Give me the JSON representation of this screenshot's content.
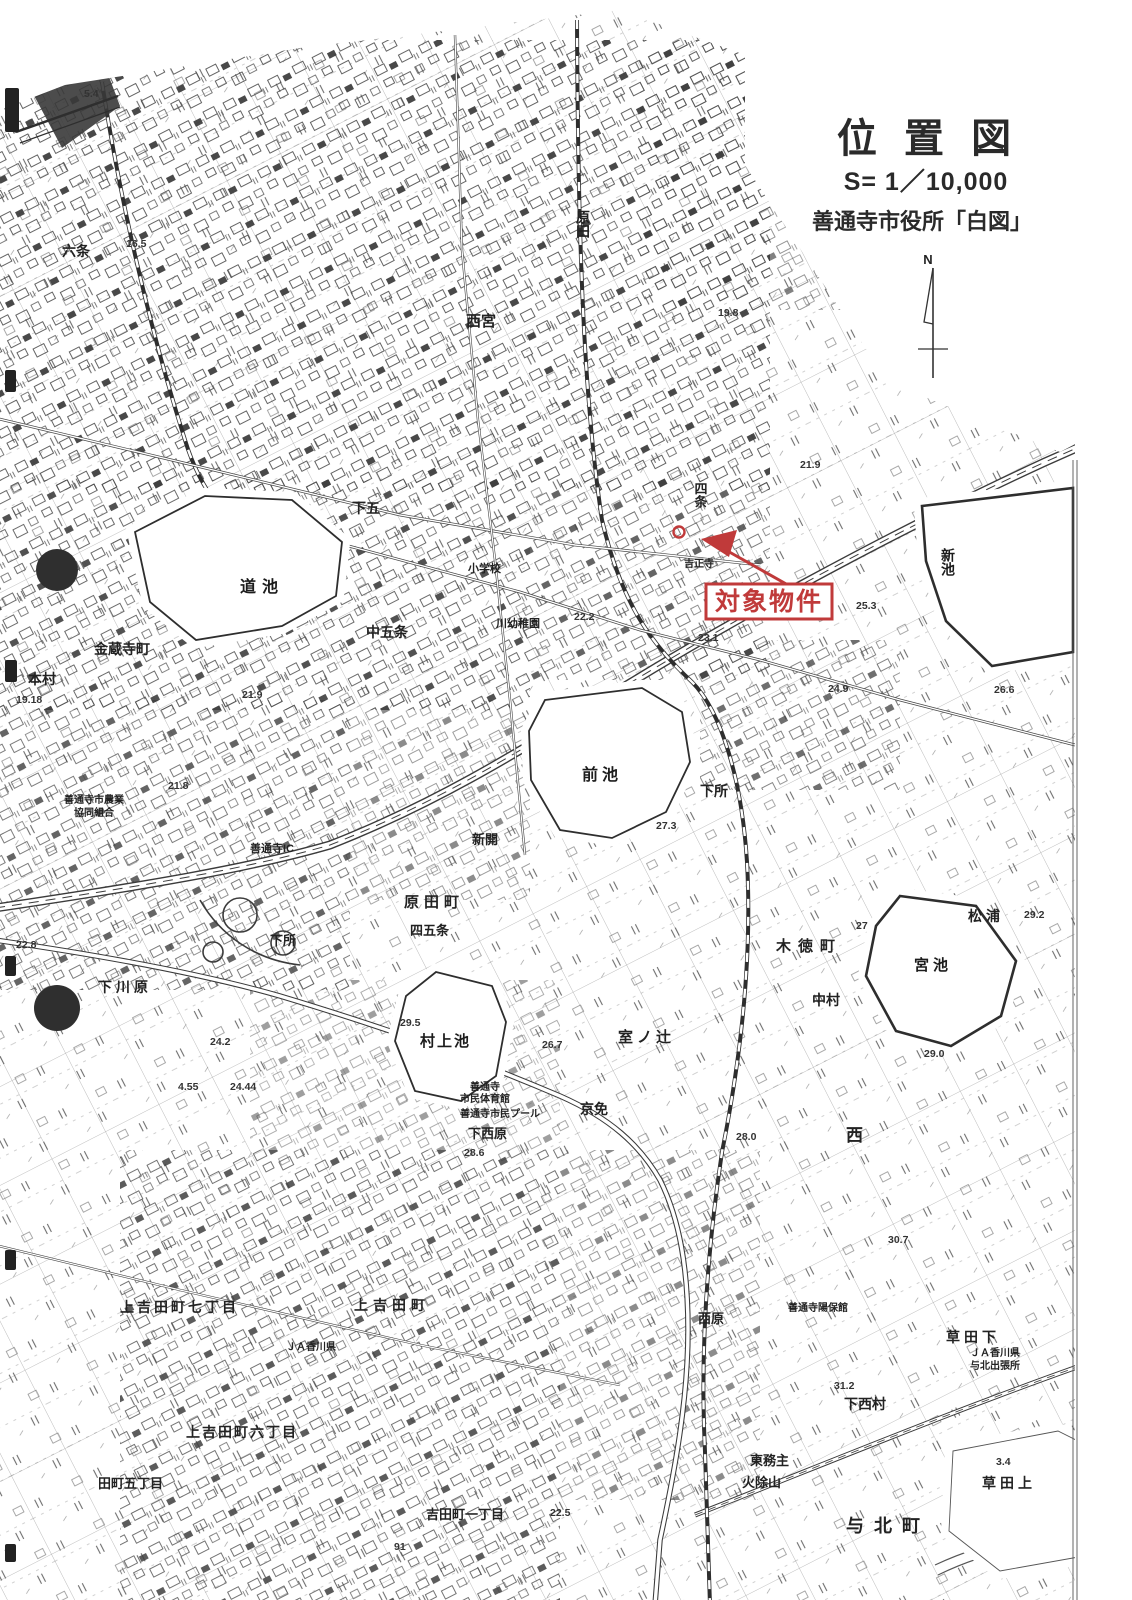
{
  "header": {
    "title": "位 置 図",
    "scale": "S= 1／10,000",
    "source": "善通寺市役所「白図」",
    "north_label": "N"
  },
  "annotation": {
    "label": "対象物件",
    "color": "#c03a3a"
  },
  "map": {
    "ink_color": "#2e2e2e",
    "paper_color": "#ffffff",
    "ponds": [
      {
        "name": "michi-ike",
        "label": "道池",
        "label_x": 240,
        "label_y": 592,
        "size": 16,
        "ls": 6
      },
      {
        "name": "mae-ike",
        "label": "前池",
        "label_x": 582,
        "label_y": 780,
        "size": 16,
        "ls": 4
      },
      {
        "name": "murakami-ike",
        "label": "村上池",
        "label_x": 420,
        "label_y": 1046,
        "size": 15,
        "ls": 2
      },
      {
        "name": "miya-ike",
        "label": "宮池",
        "label_x": 914,
        "label_y": 970,
        "size": 15,
        "ls": 4
      },
      {
        "name": "shin-ike",
        "label": "新池",
        "label_x": 948,
        "label_y": 548,
        "size": 14,
        "vertical": true
      }
    ],
    "labels": [
      {
        "text": "六条",
        "x": 62,
        "y": 256,
        "size": 14
      },
      {
        "text": "原田",
        "x": 583,
        "y": 210,
        "size": 14,
        "vertical": true
      },
      {
        "text": "西宮",
        "x": 466,
        "y": 326,
        "size": 15
      },
      {
        "text": "下五",
        "x": 352,
        "y": 513,
        "size": 14
      },
      {
        "text": "四条",
        "x": 700,
        "y": 482,
        "size": 13,
        "vertical": true
      },
      {
        "text": "中五条",
        "x": 366,
        "y": 637,
        "size": 14
      },
      {
        "text": "金蔵寺町",
        "x": 94,
        "y": 654,
        "size": 14
      },
      {
        "text": "本村",
        "x": 28,
        "y": 684,
        "size": 14
      },
      {
        "text": "小学校",
        "x": 468,
        "y": 572,
        "size": 11
      },
      {
        "text": "川幼稚園",
        "x": 496,
        "y": 627,
        "size": 11
      },
      {
        "text": "吉正寺",
        "x": 684,
        "y": 567,
        "size": 10
      },
      {
        "text": "下所",
        "x": 700,
        "y": 796,
        "size": 14
      },
      {
        "text": "下所",
        "x": 270,
        "y": 945,
        "size": 13
      },
      {
        "text": "新開",
        "x": 472,
        "y": 844,
        "size": 13
      },
      {
        "text": "原田町",
        "x": 404,
        "y": 907,
        "size": 15,
        "ls": 5
      },
      {
        "text": "四五条",
        "x": 410,
        "y": 935,
        "size": 13
      },
      {
        "text": "善通寺IC",
        "x": 250,
        "y": 852,
        "size": 11
      },
      {
        "text": "善通寺市農業",
        "x": 64,
        "y": 803,
        "size": 10
      },
      {
        "text": "協同組合",
        "x": 74,
        "y": 816,
        "size": 10
      },
      {
        "text": "下川原",
        "x": 98,
        "y": 992,
        "size": 14,
        "ls": 4
      },
      {
        "text": "室ノ辻",
        "x": 618,
        "y": 1042,
        "size": 15,
        "ls": 4
      },
      {
        "text": "京免",
        "x": 580,
        "y": 1114,
        "size": 14
      },
      {
        "text": "木徳町",
        "x": 776,
        "y": 951,
        "size": 15,
        "ls": 7
      },
      {
        "text": "中村",
        "x": 812,
        "y": 1005,
        "size": 14
      },
      {
        "text": "松浦",
        "x": 968,
        "y": 921,
        "size": 14,
        "ls": 4
      },
      {
        "text": "西",
        "x": 846,
        "y": 1141,
        "size": 17
      },
      {
        "text": "下西原",
        "x": 468,
        "y": 1138,
        "size": 13
      },
      {
        "text": "善通寺",
        "x": 470,
        "y": 1090,
        "size": 10
      },
      {
        "text": "市民体育館",
        "x": 460,
        "y": 1102,
        "size": 10
      },
      {
        "text": "善通寺市民プール",
        "x": 460,
        "y": 1117,
        "size": 10
      },
      {
        "text": "上吉田町七丁目",
        "x": 120,
        "y": 1312,
        "size": 14,
        "ls": 3
      },
      {
        "text": "上吉田町",
        "x": 354,
        "y": 1310,
        "size": 14,
        "ls": 5
      },
      {
        "text": "ＪＡ香川県",
        "x": 286,
        "y": 1350,
        "size": 10
      },
      {
        "text": "上吉田町六丁目",
        "x": 186,
        "y": 1437,
        "size": 14,
        "ls": 2
      },
      {
        "text": "田町五丁目",
        "x": 98,
        "y": 1488,
        "size": 13
      },
      {
        "text": "吉田町一丁目",
        "x": 426,
        "y": 1519,
        "size": 13
      },
      {
        "text": "西原",
        "x": 698,
        "y": 1323,
        "size": 13
      },
      {
        "text": "善通寺陽保館",
        "x": 788,
        "y": 1311,
        "size": 10
      },
      {
        "text": "草田下",
        "x": 946,
        "y": 1342,
        "size": 14,
        "ls": 4
      },
      {
        "text": "ＪＡ香川県",
        "x": 970,
        "y": 1356,
        "size": 10
      },
      {
        "text": "与北出張所",
        "x": 970,
        "y": 1369,
        "size": 10
      },
      {
        "text": "下西村",
        "x": 844,
        "y": 1409,
        "size": 14
      },
      {
        "text": "東務主",
        "x": 750,
        "y": 1465,
        "size": 13
      },
      {
        "text": "火除山",
        "x": 742,
        "y": 1487,
        "size": 13
      },
      {
        "text": "草田上",
        "x": 982,
        "y": 1488,
        "size": 14,
        "ls": 4
      },
      {
        "text": "与北町",
        "x": 846,
        "y": 1532,
        "size": 18,
        "ls": 10
      }
    ],
    "elevations": [
      {
        "text": "5.4",
        "x": 84,
        "y": 97
      },
      {
        "text": "16.5",
        "x": 126,
        "y": 247
      },
      {
        "text": "19.8",
        "x": 718,
        "y": 316
      },
      {
        "text": "21.9",
        "x": 800,
        "y": 468
      },
      {
        "text": "25.3",
        "x": 856,
        "y": 609
      },
      {
        "text": "26.6",
        "x": 994,
        "y": 693
      },
      {
        "text": "24.9",
        "x": 828,
        "y": 692
      },
      {
        "text": "22.2",
        "x": 574,
        "y": 620
      },
      {
        "text": "23.1",
        "x": 698,
        "y": 641
      },
      {
        "text": "27.3",
        "x": 656,
        "y": 829
      },
      {
        "text": "21.8",
        "x": 168,
        "y": 789
      },
      {
        "text": "21.9",
        "x": 242,
        "y": 698
      },
      {
        "text": "19.18",
        "x": 16,
        "y": 703
      },
      {
        "text": "29.5",
        "x": 400,
        "y": 1026
      },
      {
        "text": "27",
        "x": 856,
        "y": 929
      },
      {
        "text": "29.2",
        "x": 1024,
        "y": 918
      },
      {
        "text": "29.0",
        "x": 924,
        "y": 1057
      },
      {
        "text": "26.7",
        "x": 542,
        "y": 1048
      },
      {
        "text": "28.0",
        "x": 736,
        "y": 1140
      },
      {
        "text": "30.7",
        "x": 888,
        "y": 1243
      },
      {
        "text": "22.8",
        "x": 16,
        "y": 948
      },
      {
        "text": "24.2",
        "x": 210,
        "y": 1045
      },
      {
        "text": "4.55",
        "x": 178,
        "y": 1090
      },
      {
        "text": "24.44",
        "x": 230,
        "y": 1090
      },
      {
        "text": "31.2",
        "x": 834,
        "y": 1389
      },
      {
        "text": "3.4",
        "x": 996,
        "y": 1465
      },
      {
        "text": "28.6",
        "x": 464,
        "y": 1156
      },
      {
        "text": "22.5",
        "x": 550,
        "y": 1516
      },
      {
        "text": "91",
        "x": 394,
        "y": 1550
      }
    ]
  }
}
